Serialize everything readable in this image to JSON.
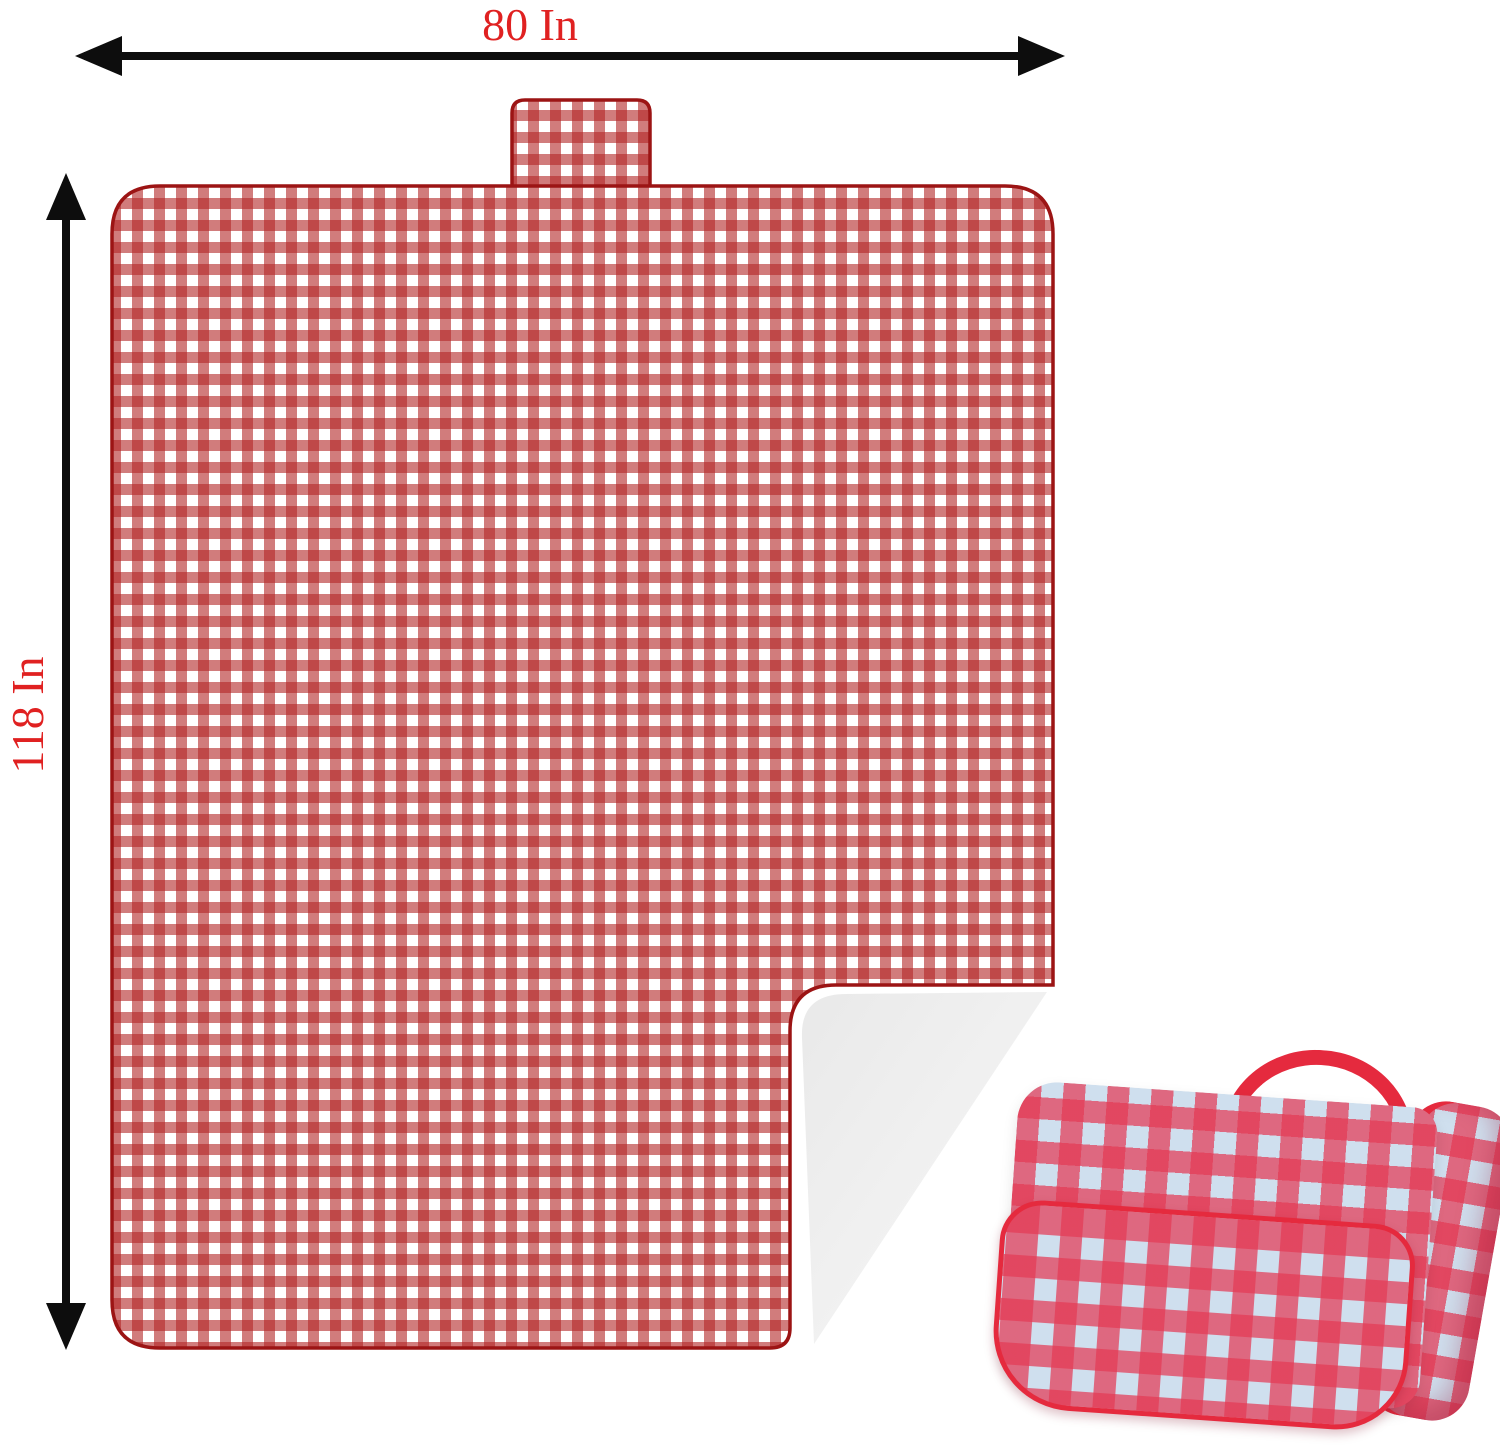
{
  "title": "Picnic blanket size diagram",
  "dimensions": {
    "width_label": "80 In",
    "height_label": "118 In"
  },
  "colors": {
    "dimension_text": "#e02121",
    "arrow": "#0d0d0d",
    "blanket_outline": "#9c1414",
    "gingham_base": "#ffffff",
    "gingham_stripe": "#b32424",
    "fold_light": "#e9e9e9",
    "fold_lighter": "#f8f8f8",
    "inset_trim": "#e52a3e",
    "inset_gingham_base": "#cfdfee",
    "inset_gingham_stripe": "#e43a55"
  },
  "icons": {
    "width_arrow": "horizontal-double-arrow",
    "height_arrow": "vertical-double-arrow"
  },
  "shapes": {
    "blanket": "gingham-blanket-top-view",
    "tab": "hanging-tab",
    "fold": "folded-corner-underside",
    "inset": "folded-blanket-photo"
  }
}
